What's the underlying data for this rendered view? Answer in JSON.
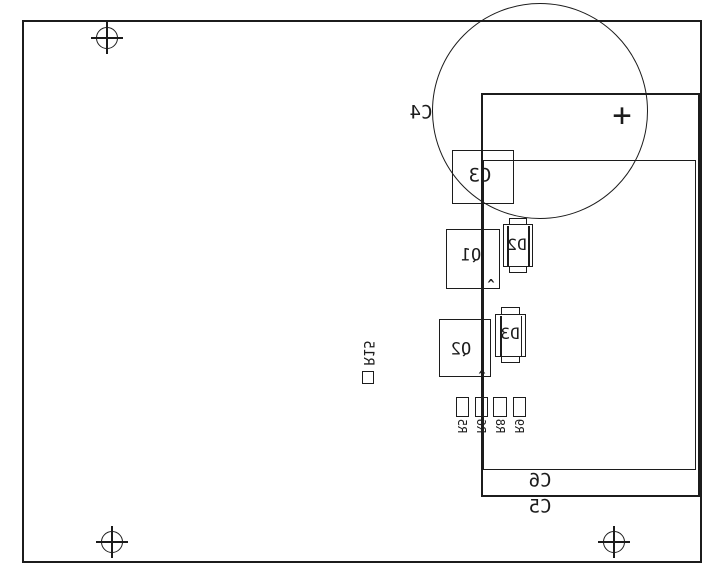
{
  "colors": {
    "line": "#1c1c1c",
    "background": "#ffffff"
  },
  "labels": {
    "c3": "C3",
    "c4": "C4",
    "c5": "C5",
    "c6": "C6",
    "d2": "D2",
    "d3": "D3",
    "q1": "Q1",
    "q2": "Q2",
    "r5": "R5",
    "r6": "R6",
    "r8": "R8",
    "r9": "R9",
    "r15": "R15",
    "plus_mark": "+",
    "pin1_marker": "^"
  }
}
